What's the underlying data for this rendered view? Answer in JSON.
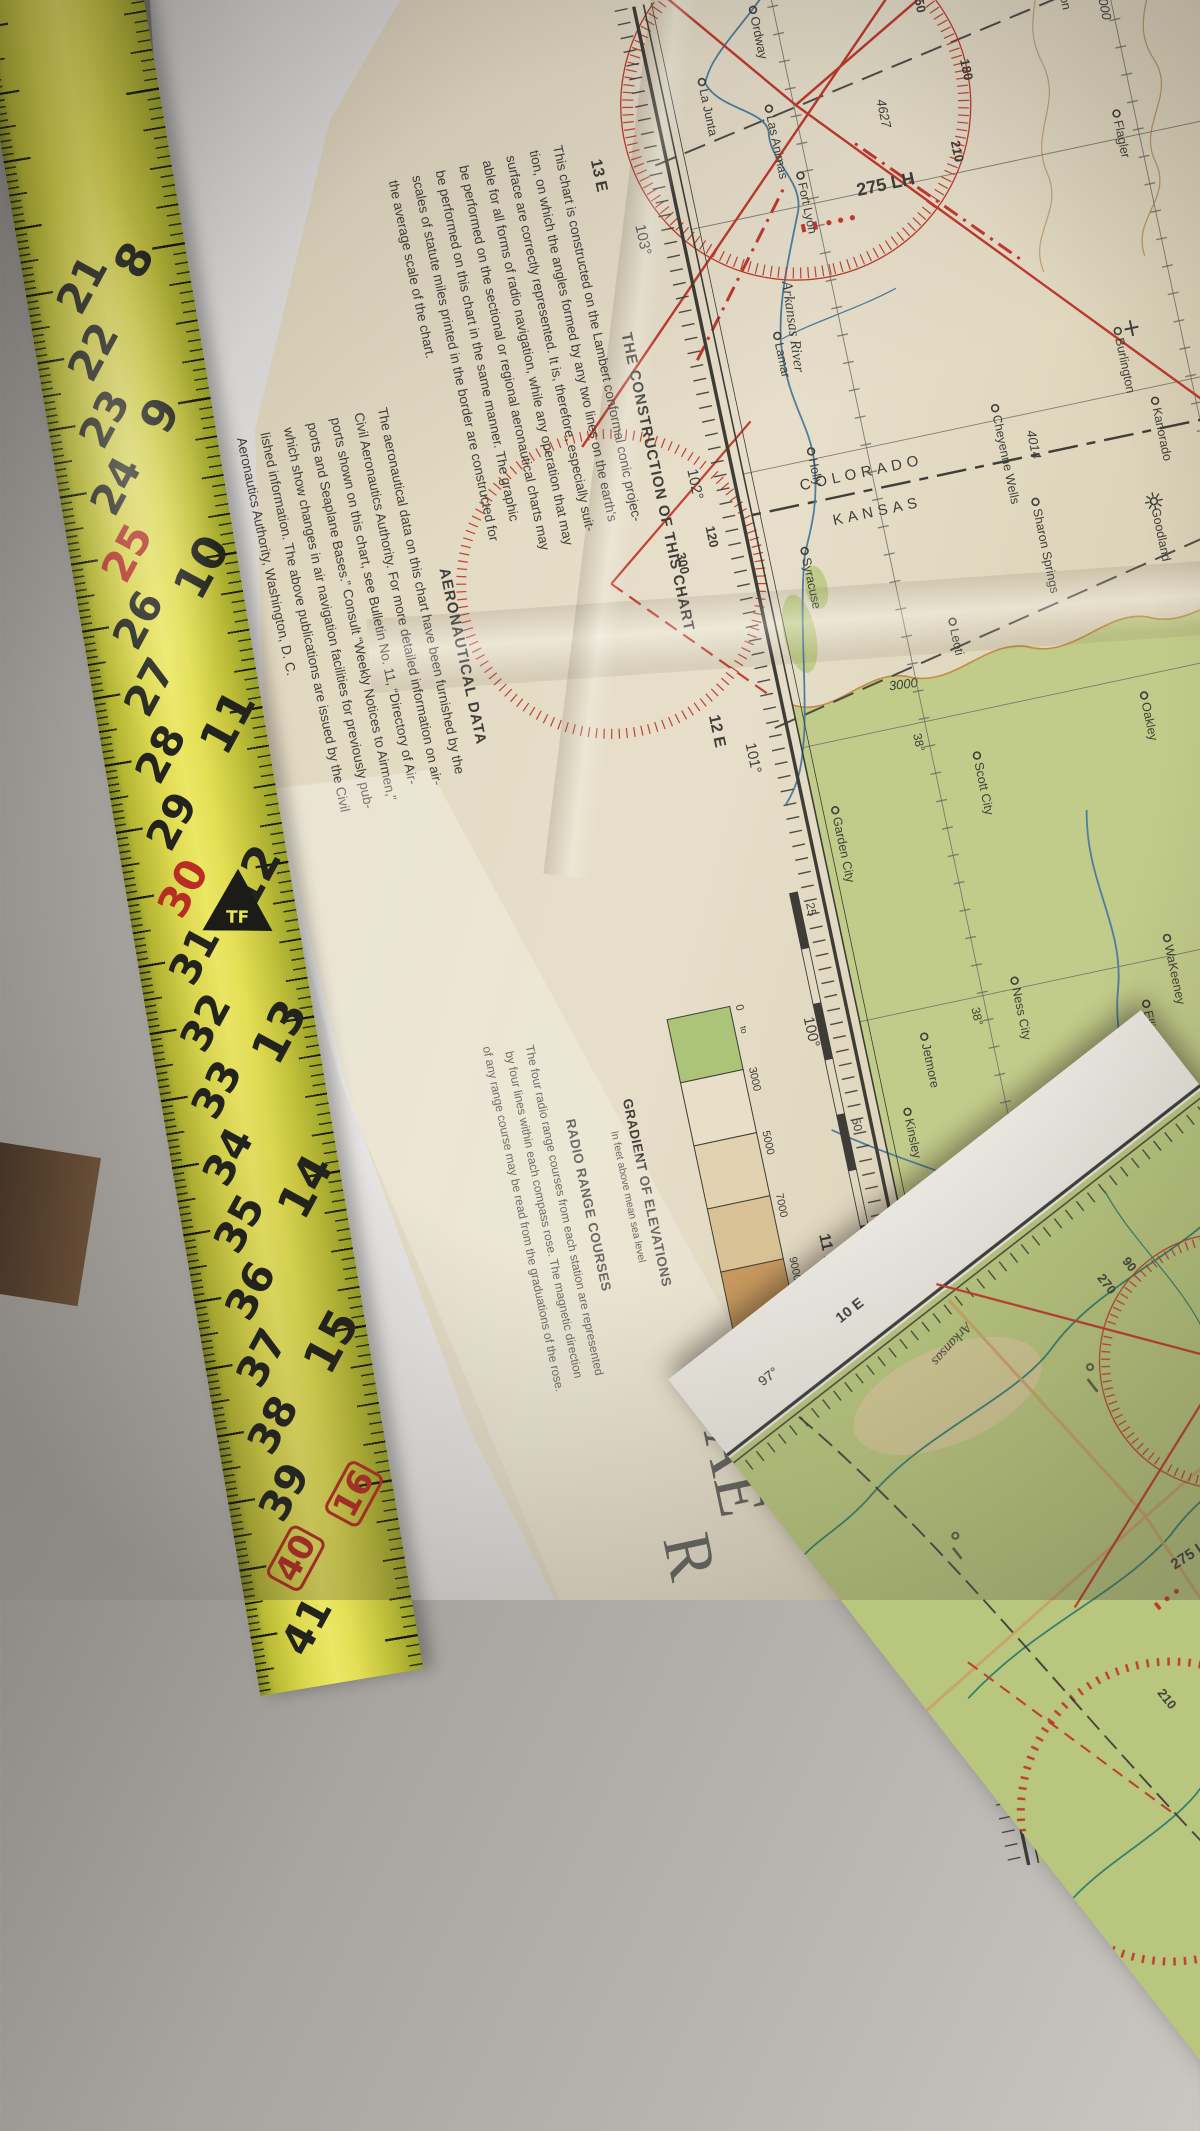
{
  "ruler": {
    "cm_numbers": [
      "21",
      "22",
      "23",
      "24",
      "25",
      "26",
      "27",
      "28",
      "29",
      "30",
      "31",
      "32",
      "33",
      "34",
      "35",
      "36",
      "37",
      "38",
      "39",
      "40",
      "41"
    ],
    "cm_red": [
      "25",
      "30"
    ],
    "cm_boxed": [
      "40"
    ],
    "inch_numbers": [
      "8",
      "9",
      "10",
      "11",
      "12",
      "13",
      "14",
      "15",
      "16"
    ],
    "inch_boxed": [
      "16"
    ],
    "logo": "TF",
    "accent_red": "#b92d24",
    "tape_yellow": "#dcd94e"
  },
  "margin_text": {
    "construction_title": "THE CONSTRUCTION OF THIS CHART",
    "construction_lines": [
      "This chart is constructed on the Lambert conformal conic projec-",
      "tion, on which the angles formed by any two lines on the earth's",
      "surface are correctly represented.  It is, therefore, especially suit-",
      "able for all forms of radio navigation, while any operation that may",
      "be performed on the sectional or regional aeronautical charts may",
      "be performed on this chart in the same manner.  The graphic",
      "scales of statute miles printed in the border are constructed for",
      "the average scale of the chart."
    ],
    "aero_title": "AERONAUTICAL DATA",
    "aero_lines": [
      "The aeronautical data on this chart have been furnished by the",
      "Civil Aeronautics Authority.  For more detailed information on air-",
      "ports shown on this chart, see Bulletin No. 11, “Directory of Air-",
      "ports and Seaplane Bases.”  Consult “Weekly Notices to Airmen,”",
      "which show changes in air navigation facilities for previously pub-",
      "lished information.  The above publications are issued by the Civil",
      "Aeronautics Authority, Washington, D. C."
    ],
    "corner_letters": [
      "AE",
      "R"
    ]
  },
  "legend": {
    "gradient_title": "GRADIENT OF ELEVATIONS",
    "gradient_subtitle": "In feet above mean sea level",
    "elevation_labels": [
      "0",
      "to",
      "3000",
      "5000",
      "7000",
      "9000",
      "14500 feet"
    ],
    "band_colors": [
      "#abc478",
      "#e9dfc9",
      "#e3d2af",
      "#d9c295",
      "#c6975c"
    ],
    "radio_title": "RADIO RANGE COURSES",
    "radio_lines": [
      "The four radio range courses from each station are represented",
      "by four lines within each compass rose.  The magnetic direction",
      "of any range course may be read from the graduations of the rose."
    ]
  },
  "border": {
    "scale_label": "STATUTE",
    "scale_numbers": [
      {
        "t": "25",
        "x": 920
      },
      {
        "t": "50",
        "x": 1140
      },
      {
        "t": "75",
        "x": 1360
      },
      {
        "t": "100",
        "x": 1580
      }
    ],
    "meridians": [
      {
        "t": "103°",
        "x": 230
      },
      {
        "t": "102°",
        "x": 480
      },
      {
        "t": "101°",
        "x": 760
      },
      {
        "t": "100°",
        "x": 1040
      }
    ],
    "isogonics": [
      {
        "t": "13 E",
        "x": 158
      },
      {
        "t": "12 E",
        "x": 726
      },
      {
        "t": "11 E",
        "x": 1256
      }
    ],
    "parallels": [
      {
        "t": "38°",
        "x": 770,
        "y": 506
      },
      {
        "t": "38°",
        "x": 1050,
        "y": 506
      },
      {
        "t": "39°",
        "x": 1050,
        "y": 176
      }
    ]
  },
  "map": {
    "state_upper": "COLORADO",
    "state_lower": "KANSAS",
    "radio_range_label": "275 LH",
    "river_main": "Arkansas  River",
    "river_smoky": "Smoky Hill",
    "river_smoky_r": "R",
    "river_saline": "Saline R",
    "river_arkansas_se": "Arkansas",
    "contour_label": "3000",
    "spot_elevations": [
      {
        "t": "·6000",
        "x": 78,
        "y": 172
      },
      {
        "t": "4627",
        "x": 142,
        "y": 410
      },
      {
        "t": "4014",
        "x": 497,
        "y": 332
      }
    ],
    "rose_numbers": [
      {
        "t": "150",
        "x": 44,
        "y": 352
      },
      {
        "t": "180",
        "x": 120,
        "y": 320
      },
      {
        "t": "210",
        "x": 198,
        "y": 346
      },
      {
        "t": "120",
        "x": 524,
        "y": 666
      },
      {
        "t": "300",
        "x": 544,
        "y": 700
      }
    ],
    "towns": [
      {
        "name": "Limon",
        "x": 52,
        "y": 205
      },
      {
        "name": "Flagler",
        "x": 205,
        "y": 178
      },
      {
        "name": "Ordway",
        "x": 28,
        "y": 512
      },
      {
        "name": "La Junta",
        "x": 88,
        "y": 577
      },
      {
        "name": "Las Animas",
        "x": 128,
        "y": 517
      },
      {
        "name": "Fort Lyon",
        "x": 200,
        "y": 500
      },
      {
        "name": "Lamar",
        "x": 352,
        "y": 556
      },
      {
        "name": "Holly",
        "x": 472,
        "y": 547
      },
      {
        "name": "Cheyenne Wells",
        "x": 468,
        "y": 358
      },
      {
        "name": "Burlington",
        "x": 418,
        "y": 222,
        "symbol": "airport"
      },
      {
        "name": "Kanorado",
        "x": 494,
        "y": 200
      },
      {
        "name": "Goodland",
        "x": 592,
        "y": 222,
        "symbol": "radio"
      },
      {
        "name": "Colby",
        "x": 720,
        "y": 196
      },
      {
        "name": "Oakley",
        "x": 780,
        "y": 272
      },
      {
        "name": "Sharon Springs",
        "x": 568,
        "y": 338
      },
      {
        "name": "Leoti",
        "x": 668,
        "y": 444
      },
      {
        "name": "Syracuse",
        "x": 568,
        "y": 574
      },
      {
        "name": "Scott City",
        "x": 804,
        "y": 448
      },
      {
        "name": "Garden City",
        "x": 828,
        "y": 598
      },
      {
        "name": "Ness City",
        "x": 1032,
        "y": 458
      },
      {
        "name": "Jetmore",
        "x": 1068,
        "y": 558
      },
      {
        "name": "Hill City",
        "x": 1036,
        "y": 216
      },
      {
        "name": "WaKeeney",
        "x": 1022,
        "y": 300
      },
      {
        "name": "Ellis",
        "x": 1082,
        "y": 334
      },
      {
        "name": "Hays",
        "x": 1148,
        "y": 336,
        "symbol": "radio"
      },
      {
        "name": "Plainville",
        "x": 1138,
        "y": 236
      },
      {
        "name": "Russell",
        "x": 1260,
        "y": 326
      },
      {
        "name": "Wilson",
        "x": 1360,
        "y": 318
      },
      {
        "name": "Ellsworth",
        "x": 1412,
        "y": 338
      },
      {
        "name": "Ellinwood",
        "x": 1378,
        "y": 366
      },
      {
        "name": "Hoisington",
        "x": 1297,
        "y": 410
      },
      {
        "name": "Great Bend",
        "x": 1276,
        "y": 452
      },
      {
        "name": "Larned",
        "x": 1224,
        "y": 508
      },
      {
        "name": "La Crosse",
        "x": 1168,
        "y": 420
      },
      {
        "name": "St. John",
        "x": 1340,
        "y": 552
      },
      {
        "name": "Kinsley",
        "x": 1138,
        "y": 590
      }
    ]
  },
  "panel_b": {
    "meridian": "97°",
    "isogonic": "10 E",
    "radio_range_label": "275 LH",
    "river_label": "Arkansas",
    "rose_numbers": [
      {
        "t": "90",
        "x": 186,
        "y": 170
      },
      {
        "t": "270",
        "x": 184,
        "y": 200
      },
      {
        "t": "120",
        "x": 390,
        "y": 66
      },
      {
        "t": "300",
        "x": 402,
        "y": 98
      },
      {
        "t": "210",
        "x": 548,
        "y": 408
      }
    ]
  },
  "colors": {
    "print_black": "#3f3e39",
    "print_red": "#c0392d",
    "river_blue": "#4e7d9e",
    "river_teal": "#2e7c6e",
    "terrain_green": "#c2cc8a",
    "contour_orange": "#bf8033",
    "paper_cream": "#e2d9c2"
  }
}
